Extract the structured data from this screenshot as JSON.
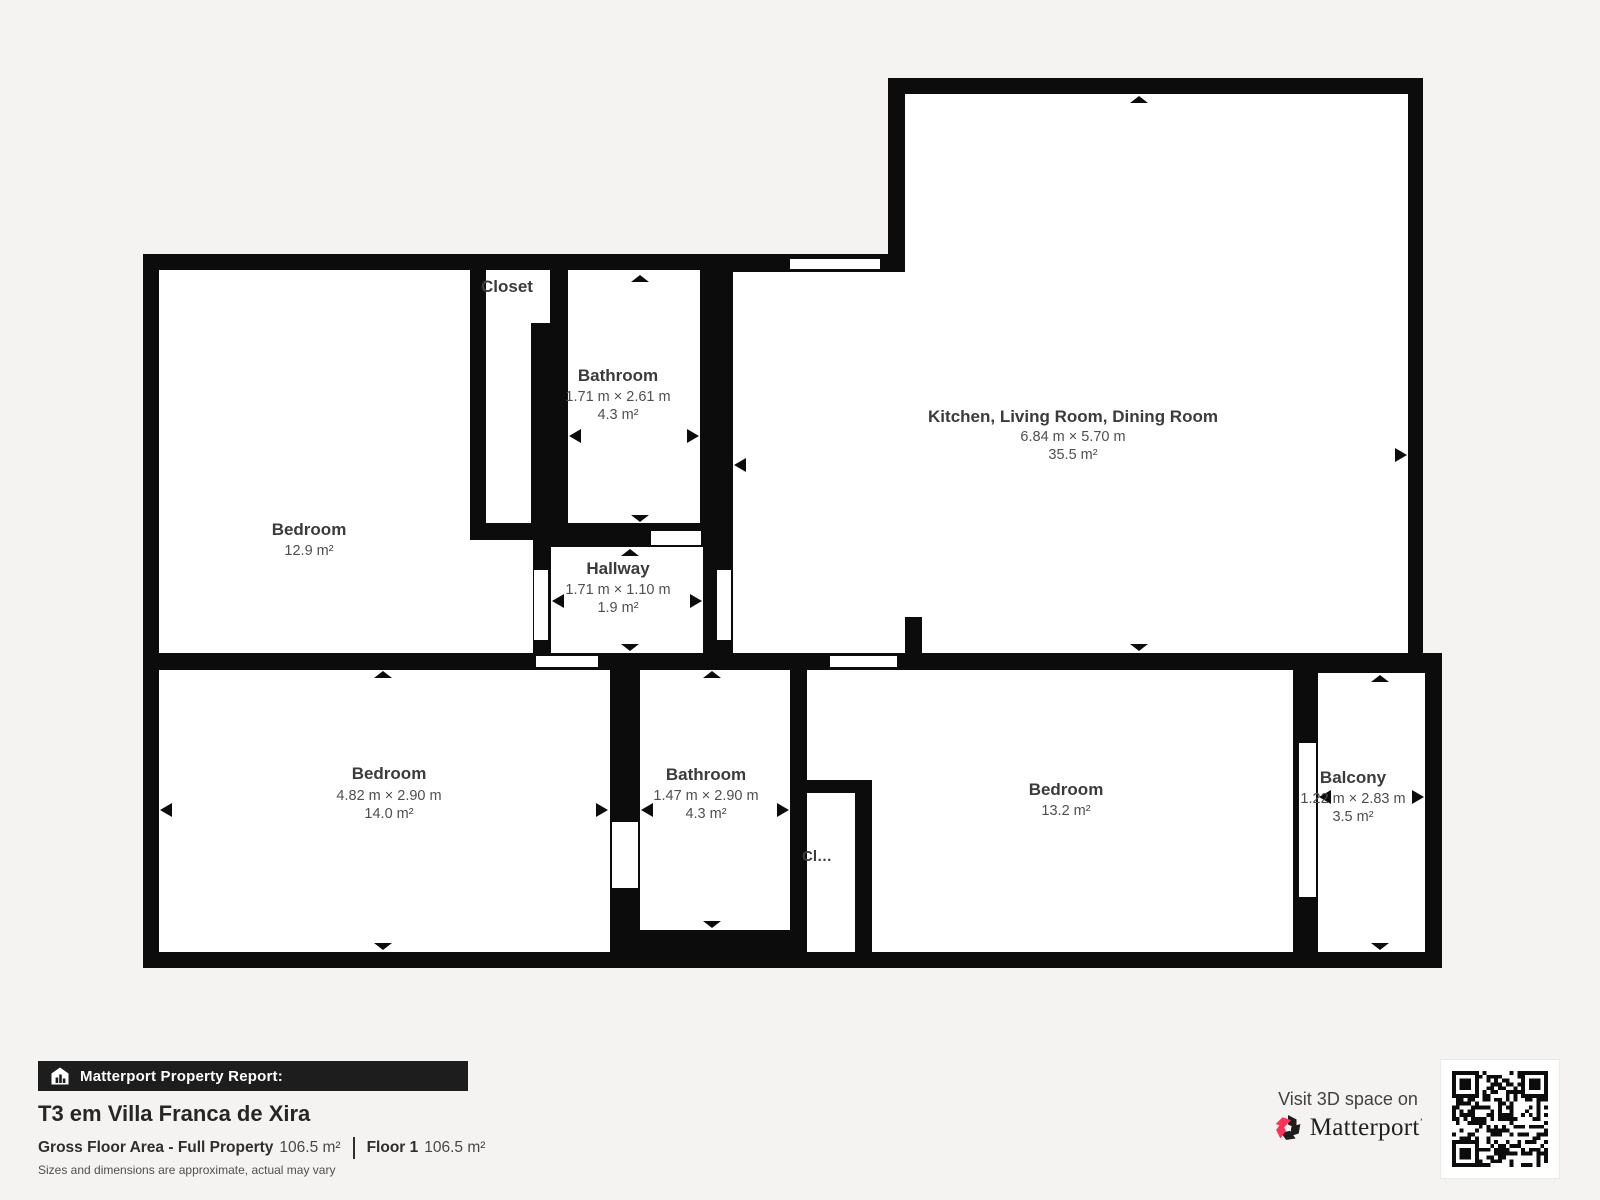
{
  "floorplan": {
    "rooms": [
      {
        "id": "closet-top",
        "name": "Closet"
      },
      {
        "id": "bathroom-top",
        "name": "Bathroom",
        "dims": "1.71 m × 2.61 m",
        "area": "4.3 m²"
      },
      {
        "id": "kitchen-living-dining",
        "name": "Kitchen, Living Room, Dining Room",
        "dims": "6.84 m × 5.70 m",
        "area": "35.5 m²"
      },
      {
        "id": "bedroom-top-left",
        "name": "Bedroom",
        "area": "12.9 m²"
      },
      {
        "id": "hallway",
        "name": "Hallway",
        "dims": "1.71 m × 1.10 m",
        "area": "1.9 m²"
      },
      {
        "id": "bedroom-bottom-left",
        "name": "Bedroom",
        "dims": "4.82 m × 2.90 m",
        "area": "14.0 m²"
      },
      {
        "id": "bathroom-bottom",
        "name": "Bathroom",
        "dims": "1.47 m × 2.90 m",
        "area": "4.3 m²"
      },
      {
        "id": "closet-bottom",
        "name": "Cl…"
      },
      {
        "id": "bedroom-bottom-right",
        "name": "Bedroom",
        "area": "13.2 m²"
      },
      {
        "id": "balcony",
        "name": "Balcony",
        "dims": "1.22 m × 2.83 m",
        "area": "3.5 m²"
      }
    ],
    "colors": {
      "wall": "#0c0c0c",
      "room": "#ffffff",
      "background": "#f4f3f1"
    }
  },
  "footer": {
    "report_label": "Matterport Property Report:",
    "property_title": "T3 em Villa Franca de Xira",
    "gross_area_label": "Gross Floor Area - Full Property",
    "gross_area_value": "106.5 m²",
    "floor_label": "Floor 1",
    "floor_value": "106.5 m²",
    "note": "Sizes and dimensions are approximate, actual may vary",
    "visit_text": "Visit 3D space on",
    "brand": "Matterport",
    "brand_accent": "#ff3158"
  }
}
